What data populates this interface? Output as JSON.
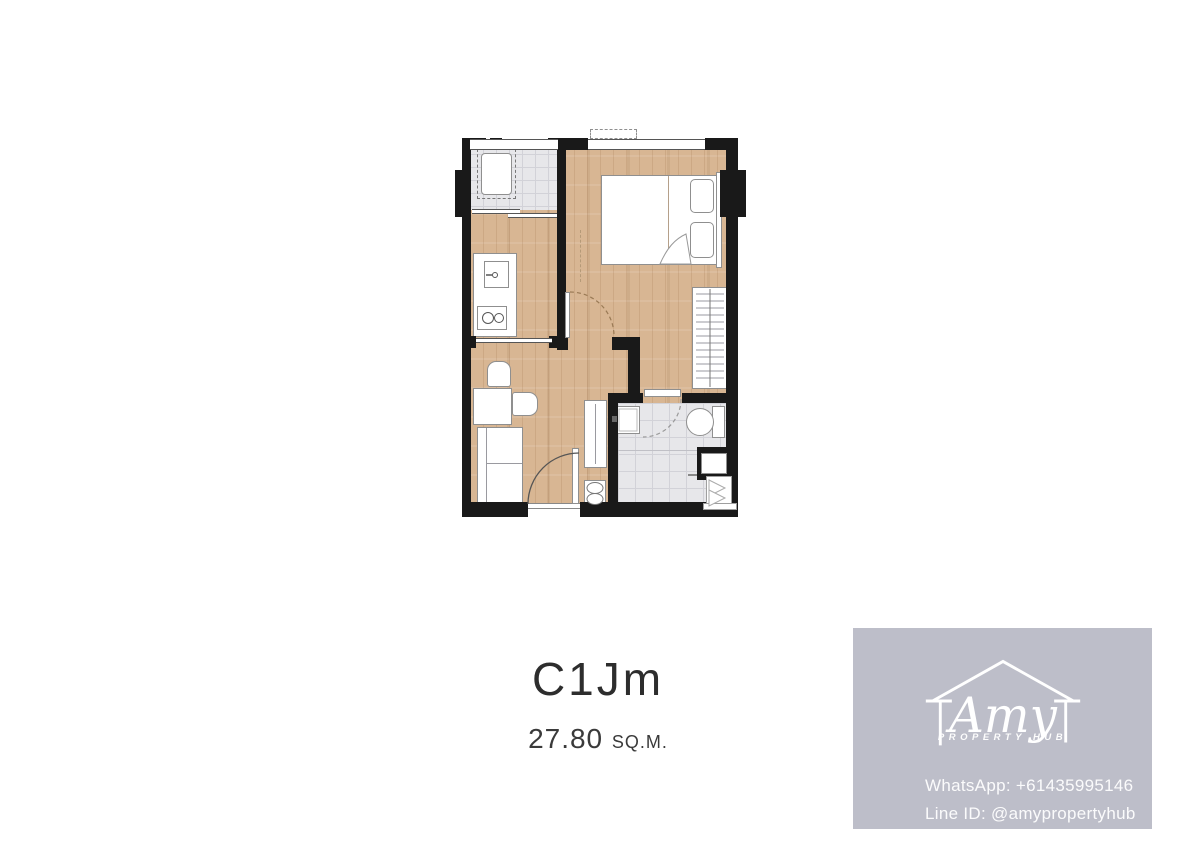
{
  "unit": {
    "name": "C1Jm",
    "area_value": "27.80",
    "area_unit": "SQ.M."
  },
  "watermark": {
    "script_name": "Amy",
    "subtitle": "PROPERTY HUB",
    "whatsapp": "WhatsApp: +61435995146",
    "line_id": "Line ID: @amypropertyhub"
  },
  "colors": {
    "wood": "#d8b693",
    "tile": "#e7e7ea",
    "wall": "#191919",
    "panel": "#bdbec9",
    "ink": "#2d2d2d",
    "white": "#ffffff"
  }
}
